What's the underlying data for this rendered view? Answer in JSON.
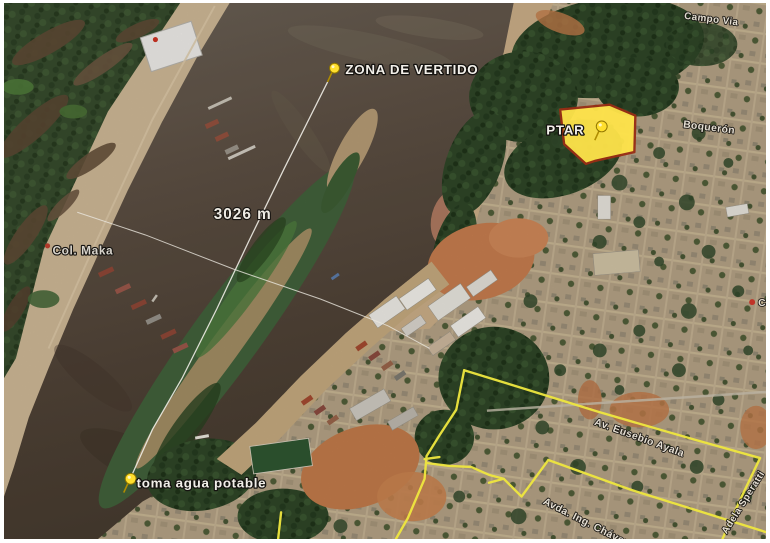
{
  "map": {
    "type": "satellite-imagery",
    "placemarks": [
      {
        "id": "zona-de-vertido",
        "label": "ZONA DE VERTIDO",
        "icon": "yellow-pushpin"
      },
      {
        "id": "ptar",
        "label": "PTAR",
        "icon": "yellow-pushpin"
      },
      {
        "id": "toma-agua-potable",
        "label": "toma agua potable",
        "icon": "yellow-pushpin"
      }
    ],
    "measurement": {
      "distance_label": "3026 m"
    },
    "places": [
      {
        "id": "col-maka",
        "label": "Col. Maka",
        "icon": "red-dot"
      },
      {
        "id": "edge-partial",
        "label": "Ca",
        "icon": "red-dot"
      }
    ],
    "streets": [
      {
        "id": "campo-via",
        "label": "Campo Via"
      },
      {
        "id": "boqueron",
        "label": "Boquerón"
      },
      {
        "id": "av-eusebio-ayala",
        "label": "Av. Eusebio Ayala"
      },
      {
        "id": "avda-ing-chavez",
        "label": "Avda. Ing. Chávez"
      },
      {
        "id": "adela-speratti",
        "label": "Adela Speratti"
      }
    ],
    "highlighted_area": {
      "id": "ptar-site",
      "fill": "#ffe44a",
      "stroke": "#992d14"
    },
    "colors": {
      "boundary_line": "#efe73f",
      "pushpin": "#ffdf2e",
      "label": "#f2efe9"
    }
  }
}
